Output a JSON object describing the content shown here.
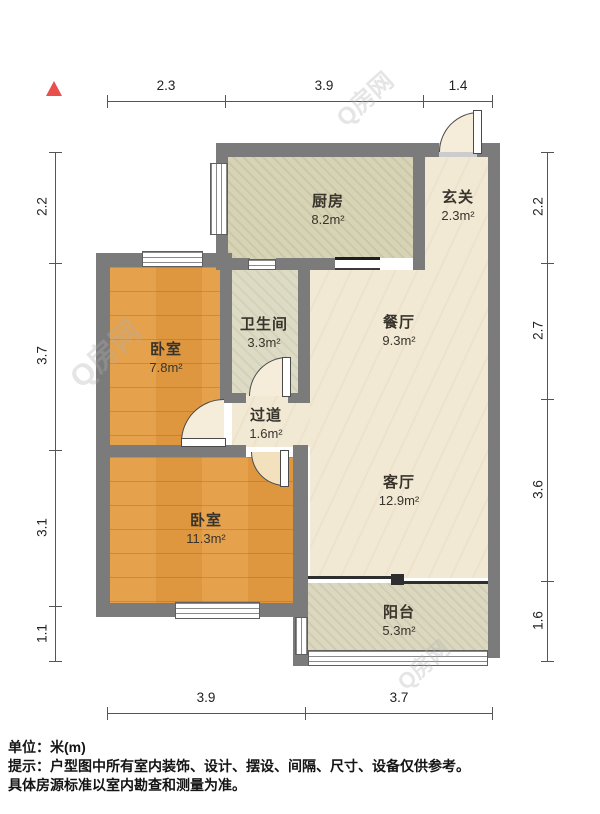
{
  "watermark": "Q房网",
  "rooms": {
    "kitchen": {
      "name": "厨房",
      "area": "8.2m²"
    },
    "entry": {
      "name": "玄关",
      "area": "2.3m²"
    },
    "bathroom": {
      "name": "卫生间",
      "area": "3.3m²"
    },
    "dining": {
      "name": "餐厅",
      "area": "9.3m²"
    },
    "bedroom1": {
      "name": "卧室",
      "area": "7.8m²"
    },
    "hallway": {
      "name": "过道",
      "area": "1.6m²"
    },
    "living": {
      "name": "客厅",
      "area": "12.9m²"
    },
    "bedroom2": {
      "name": "卧室",
      "area": "11.3m²"
    },
    "balcony": {
      "name": "阳台",
      "area": "5.3m²"
    }
  },
  "dimensions": {
    "top": [
      "2.3",
      "3.9",
      "1.4"
    ],
    "bottom": [
      "3.9",
      "3.7"
    ],
    "left": [
      "2.2",
      "3.7",
      "3.1",
      "1.1"
    ],
    "right": [
      "2.2",
      "2.7",
      "3.6",
      "1.6"
    ]
  },
  "footer": {
    "unit": "单位：米(m)",
    "tip": "提示：户型图中所有室内装饰、设计、摆设、间隔、尺寸、设备仅供参考。",
    "tip2": "具体房源标准以室内勘查和测量为准。"
  },
  "colors": {
    "wall": "#7b7b7b",
    "wood_floor": "#e49c42",
    "cream_floor": "#f2e9d5",
    "north_arrow": "#e8504c"
  }
}
